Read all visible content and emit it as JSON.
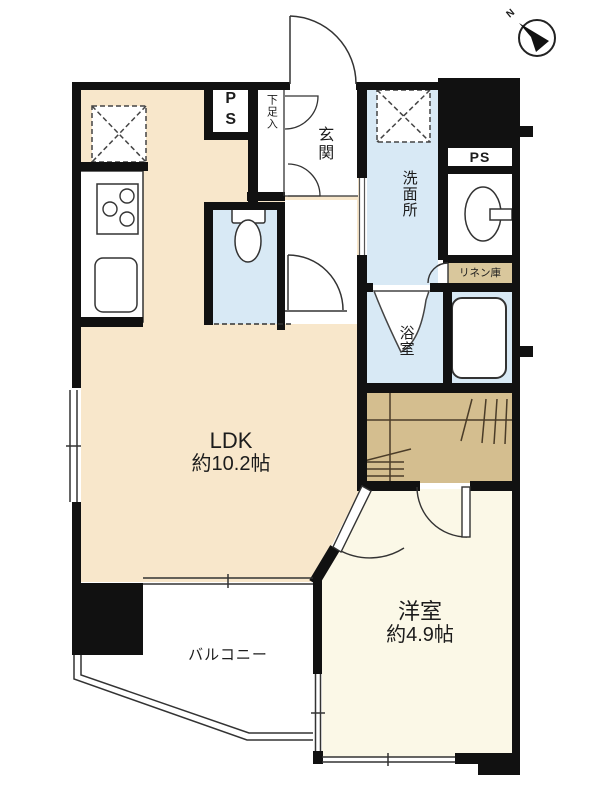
{
  "rooms": {
    "ldk": {
      "name": "LDK",
      "size": "約10.2帖"
    },
    "bedroom": {
      "name": "洋室",
      "size": "約4.9帖"
    },
    "entrance": {
      "name": "玄関"
    },
    "shoe_cabinet": {
      "name": "下足入"
    },
    "washroom": {
      "name": "洗面所"
    },
    "bathroom": {
      "name": "浴室"
    },
    "linen_closet": {
      "name": "リネン庫"
    },
    "balcony": {
      "name": "バルコニー"
    },
    "pipe_space_left": {
      "name": "PS"
    },
    "pipe_space_right": {
      "name": "PS"
    }
  },
  "compass": {
    "north": "N"
  },
  "colors": {
    "ldk_floor": "#F8E7CB",
    "wet_area_floor": "#D8E9F5",
    "closet_floor": "#D4BE8F",
    "bedroom_floor": "#FBF8E7",
    "wall": "#111111",
    "background": "#FFFFFF"
  }
}
